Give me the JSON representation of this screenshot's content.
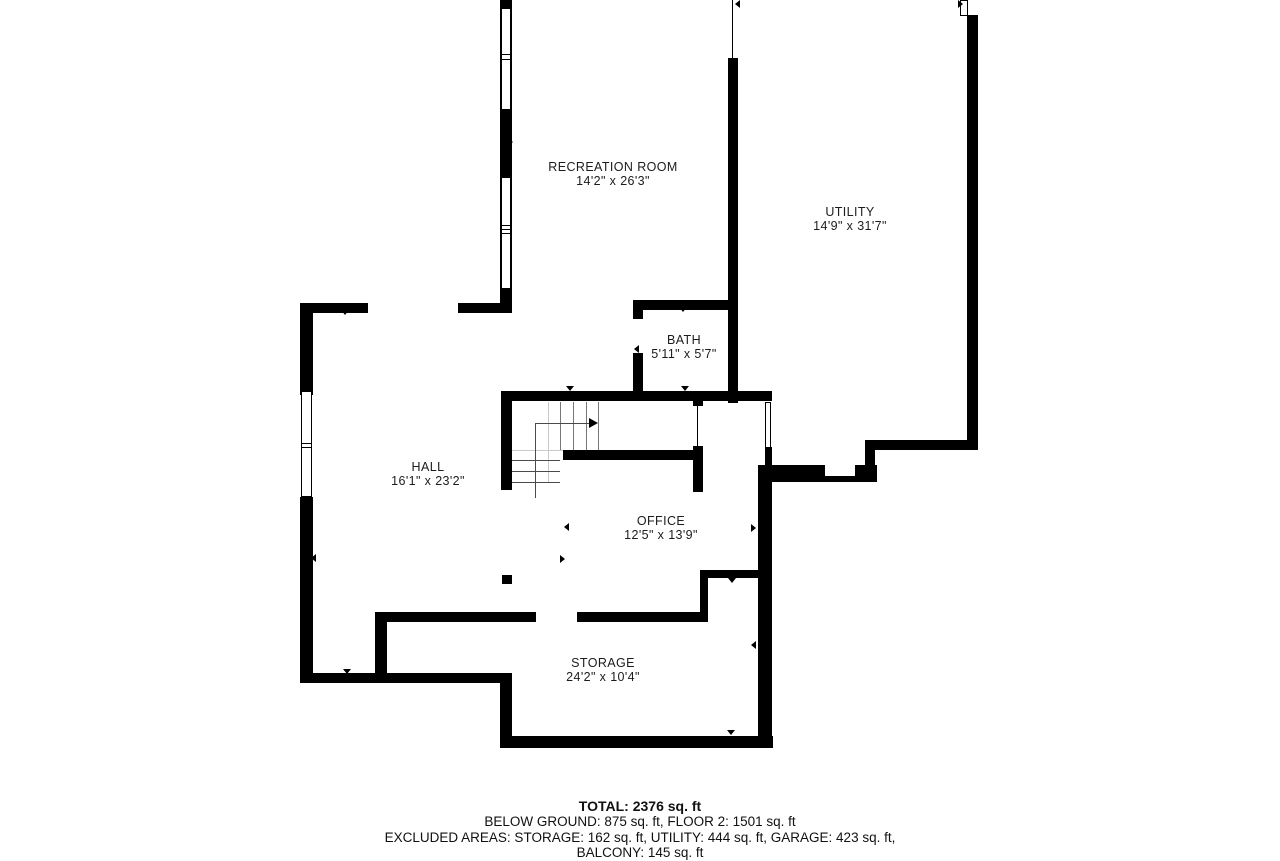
{
  "plan": {
    "title": "Below ground floor plan",
    "rooms": [
      {
        "name": "RECREATION ROOM",
        "dims": "14'2\" x 26'3\""
      },
      {
        "name": "UTILITY",
        "dims": "14'9\" x 31'7\""
      },
      {
        "name": "BATH",
        "dims": "5'11\" x 5'7\""
      },
      {
        "name": "HALL",
        "dims": "16'1\" x 23'2\""
      },
      {
        "name": "OFFICE",
        "dims": "12'5\" x 13'9\""
      },
      {
        "name": "STORAGE",
        "dims": "24'2\" x 10'4\""
      }
    ]
  },
  "summary": {
    "total": "TOTAL: 2376 sq. ft",
    "floors": "BELOW GROUND: 875 sq. ft, FLOOR 2: 1501 sq. ft",
    "excluded": "EXCLUDED AREAS: STORAGE: 162 sq. ft, UTILITY: 444 sq. ft, GARAGE: 423 sq. ft,",
    "excluded2": "BALCONY: 145 sq. ft"
  },
  "colors": {
    "wall": "#000000",
    "background": "#ffffff",
    "stair_lines": "#777777"
  }
}
